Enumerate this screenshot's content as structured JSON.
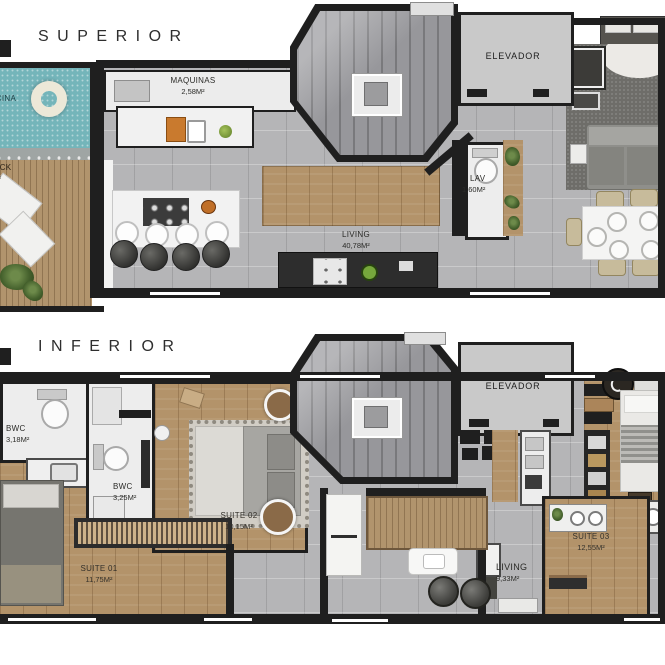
{
  "palette": {
    "wall": "#1f1f1f",
    "tile_floor": "#b5b5b7",
    "wood_floor": "#b3936a",
    "deck_wood": "#b1946d",
    "pool_water": "#74b5ba",
    "elevator_floor": "#c9c9c9",
    "stair_floor": "#97979b",
    "white_floor": "#ededed",
    "rug": "#d1cdc5",
    "sofa": "#8f8f8b",
    "accent_orange": "#c06f28",
    "accent_green": "#76a73c"
  },
  "floors": [
    {
      "title": "SUPERIOR",
      "rooms": {
        "piscina": {
          "name": "PISCINA",
          "area": "4M²"
        },
        "deck": {
          "name": "DECK",
          "area": "2M²"
        },
        "maquinas": {
          "name": "MAQUINAS",
          "area": "2,58M²"
        },
        "elevador": {
          "name": "ELEVADOR"
        },
        "lav": {
          "name": "LAV",
          "area": "1,60M²"
        },
        "living": {
          "name": "LIVING",
          "area": "40,78M²"
        }
      }
    },
    {
      "title": "INFERIOR",
      "rooms": {
        "bwc1": {
          "name": "BWC",
          "area": "3,18M²"
        },
        "bwc2": {
          "name": "BWC",
          "area": "3,25M²"
        },
        "suite02": {
          "name": "SUITE 02",
          "area": "10,15M²"
        },
        "suite01": {
          "name": "SUITE 01",
          "area": "11,75M²"
        },
        "elevador": {
          "name": "ELEVADOR"
        },
        "suite03": {
          "name": "SUITE 03",
          "area": "12,55M²"
        },
        "living": {
          "name": "LIVING",
          "area": "9,33M²"
        }
      }
    }
  ]
}
